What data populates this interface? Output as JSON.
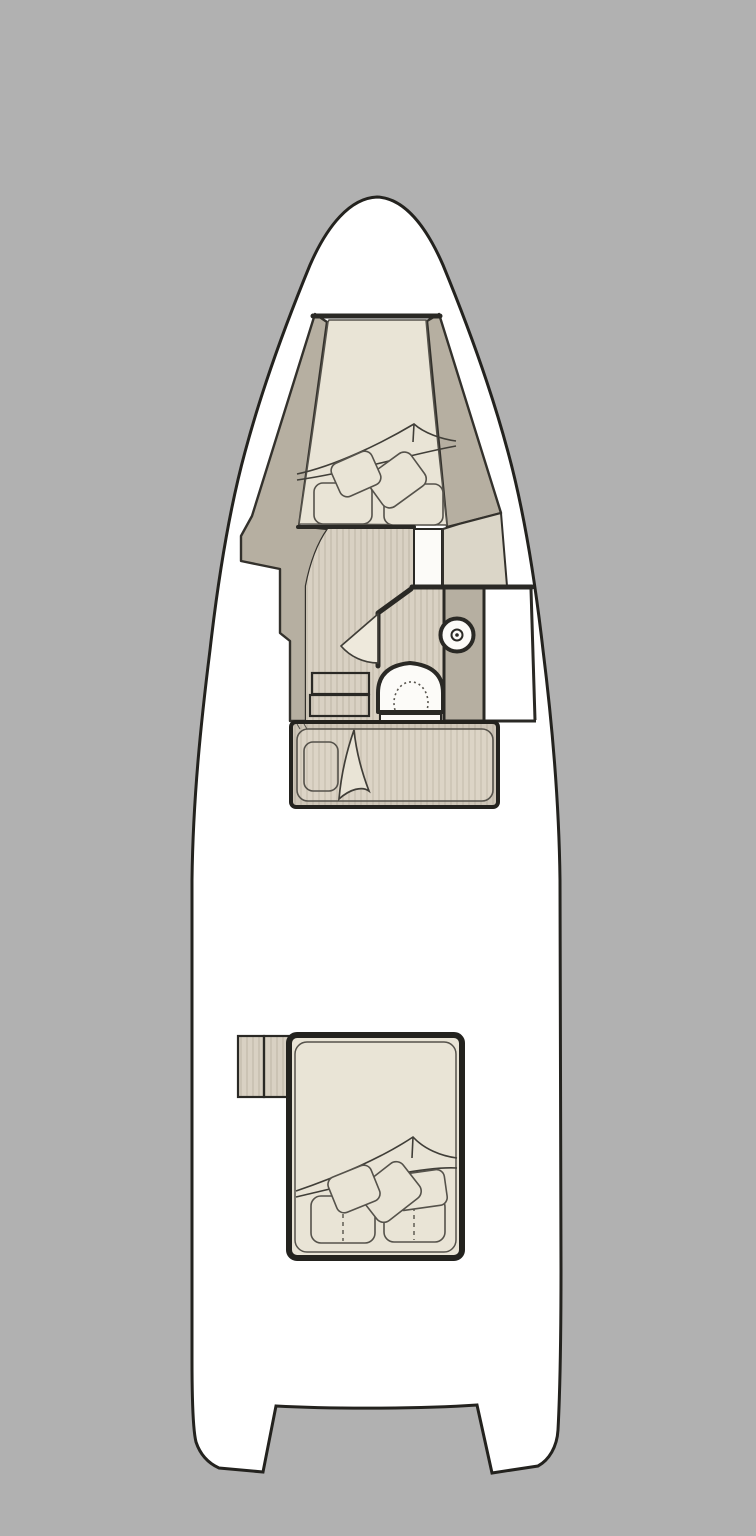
{
  "diagram": {
    "type": "boat-deck-floor-plan",
    "orientation": "bow-up",
    "features": [
      {
        "id": "hull",
        "description": "motor-yacht hull outline with twin stern legs and transom notch"
      },
      {
        "id": "bow-cabin",
        "description": "V-berth double bed with two base cushions, two tilted pillows and folded sheet"
      },
      {
        "id": "companionway",
        "description": "striped corridor floor with two steps on port side"
      },
      {
        "id": "doorway",
        "description": "white door opening between corridor and starboard locker panel"
      },
      {
        "id": "head-compartment",
        "description": "bathroom with angled bulkhead, swing door, toilet and round washbasin on counter"
      },
      {
        "id": "mid-berth",
        "description": "single berth amidships with pillow and folded blanket"
      },
      {
        "id": "aft-steps",
        "description": "two-tread step block at aft cabin entry"
      },
      {
        "id": "aft-cabin",
        "description": "aft double bed with two base cushions, three tilted pillows and folded sheet"
      }
    ]
  },
  "colors": {
    "background": "#b1b1b1",
    "hull_fill": "#ffffff",
    "outline_dark": "#23221e",
    "line_dark": "#2a2925",
    "wall_edge": "#33312c",
    "wall_taupe": "#b6afa1",
    "panel_light": "#dbd6c8",
    "cabin_cream": "#e9e4d6",
    "floor_base": "#d9d1c3",
    "floor_stripe": "#cbc3b4",
    "bed_base": "#dcd4c6",
    "bed_stripe": "#cfc7b8",
    "bed_border_base": "#cec6b8",
    "bed_border_stripe": "#c3bbad",
    "fixture_white": "#fcfbf8",
    "thin_line": "#55524b",
    "fold_line": "#403e38",
    "dot_line": "#5a5750",
    "door_leaf": "#eee9dc"
  }
}
